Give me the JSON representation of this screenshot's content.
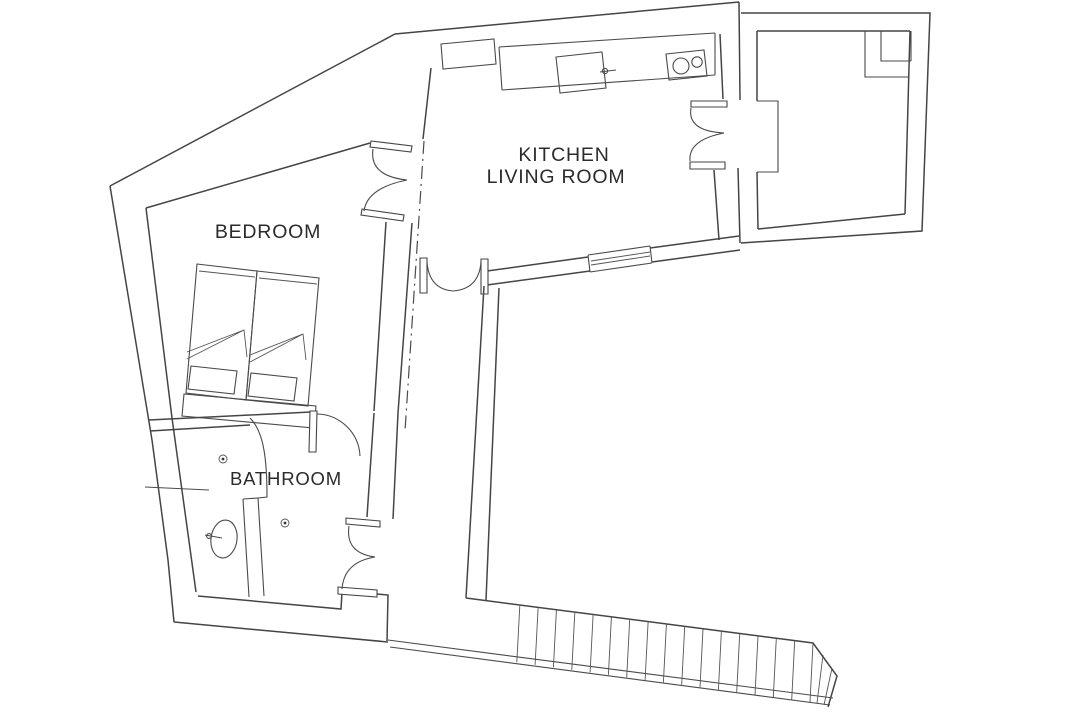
{
  "plan": {
    "type": "apartment-floor-plan",
    "background_color": "#ffffff",
    "line_color": "#454545",
    "text_color": "#2b2b2b"
  },
  "rooms": {
    "kitchen_living": {
      "label_line1": "KITCHEN",
      "label_line2": "LIVING ROOM"
    },
    "bedroom": {
      "label": "BEDROOM"
    },
    "bathroom": {
      "label": "BATHROOM"
    }
  },
  "stairs": {
    "tread_count": 17
  },
  "fixtures": {
    "kitchen": [
      "kitchen-counter",
      "kitchen-sink",
      "sink-faucet",
      "stove-two-burners",
      "wall-cupboard",
      "window"
    ],
    "bedroom": [
      "single-bed-left",
      "single-bed-right",
      "pillows",
      "folded-blankets",
      "headboard-bench"
    ],
    "bathroom": [
      "wash-basin",
      "basin-faucet",
      "floor-drain-1",
      "floor-drain-2",
      "curved-shower-wall"
    ],
    "doors": [
      "double-door-bedroom-kitchen",
      "double-door-hall",
      "double-door-kitchen-terrace",
      "single-door-bathroom",
      "double-door-bathroom-exit"
    ],
    "circulation": [
      "staircase-down"
    ]
  }
}
